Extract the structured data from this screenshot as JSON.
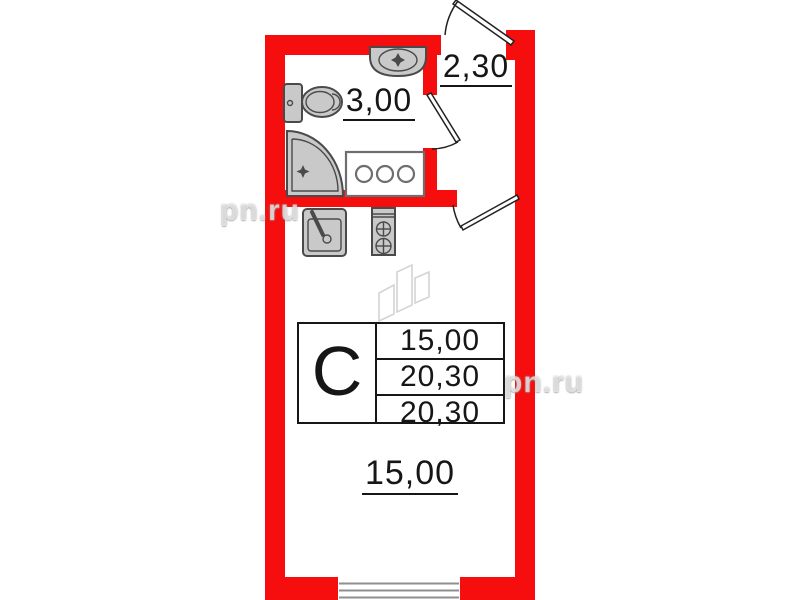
{
  "watermark": {
    "text": "pn.ru"
  },
  "labels": {
    "bathroom_area": "3,00",
    "hall_area": "2,30",
    "room_area": "15,00"
  },
  "info_table": {
    "unit_type": "С",
    "rows": [
      "15,00",
      "20,30",
      "20,30"
    ]
  },
  "colors": {
    "wall": "#f60d0d",
    "fixture_fill": "#c9c9c9",
    "fixture_stroke": "#4a4a4a",
    "sketch": "#d4d4d4",
    "window_line": "#8f8f8f",
    "text": "#161616"
  }
}
